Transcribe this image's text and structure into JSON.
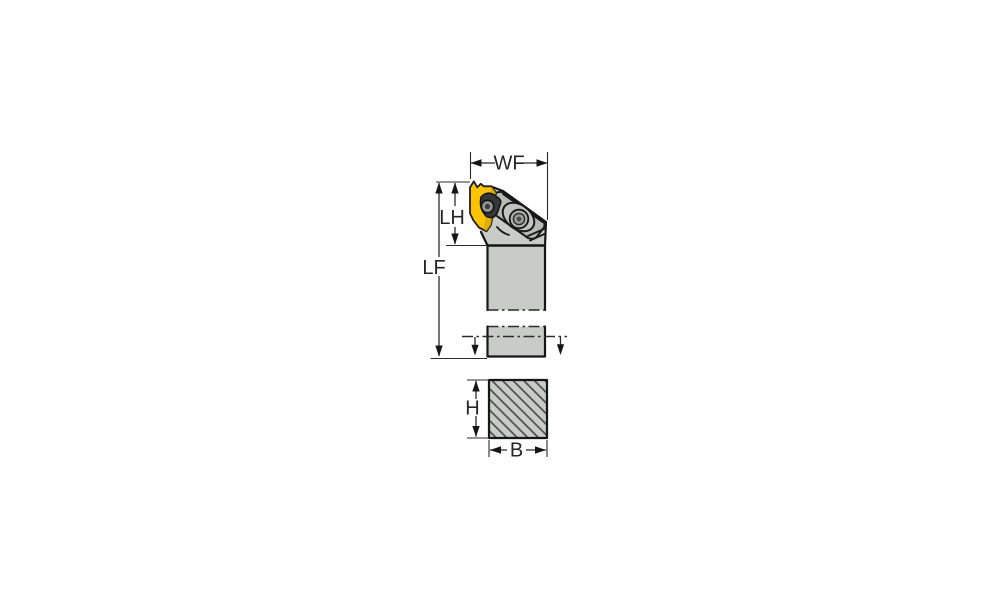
{
  "drawing": {
    "labels": {
      "wf": "WF",
      "lh": "LH",
      "lf": "LF",
      "h": "H",
      "b": "B"
    },
    "colors": {
      "background": "#ffffff",
      "body": "#c7cdc6",
      "body_shade": "#b6bcb4",
      "insert": "#fcc400",
      "insert_shade": "#d9a500",
      "clamp_dark": "#373737",
      "screw_metal": "#9a9f98",
      "outline": "#161616",
      "dimension_line": "#2b2b2b",
      "hatch_line": "#4c4c4c"
    }
  }
}
